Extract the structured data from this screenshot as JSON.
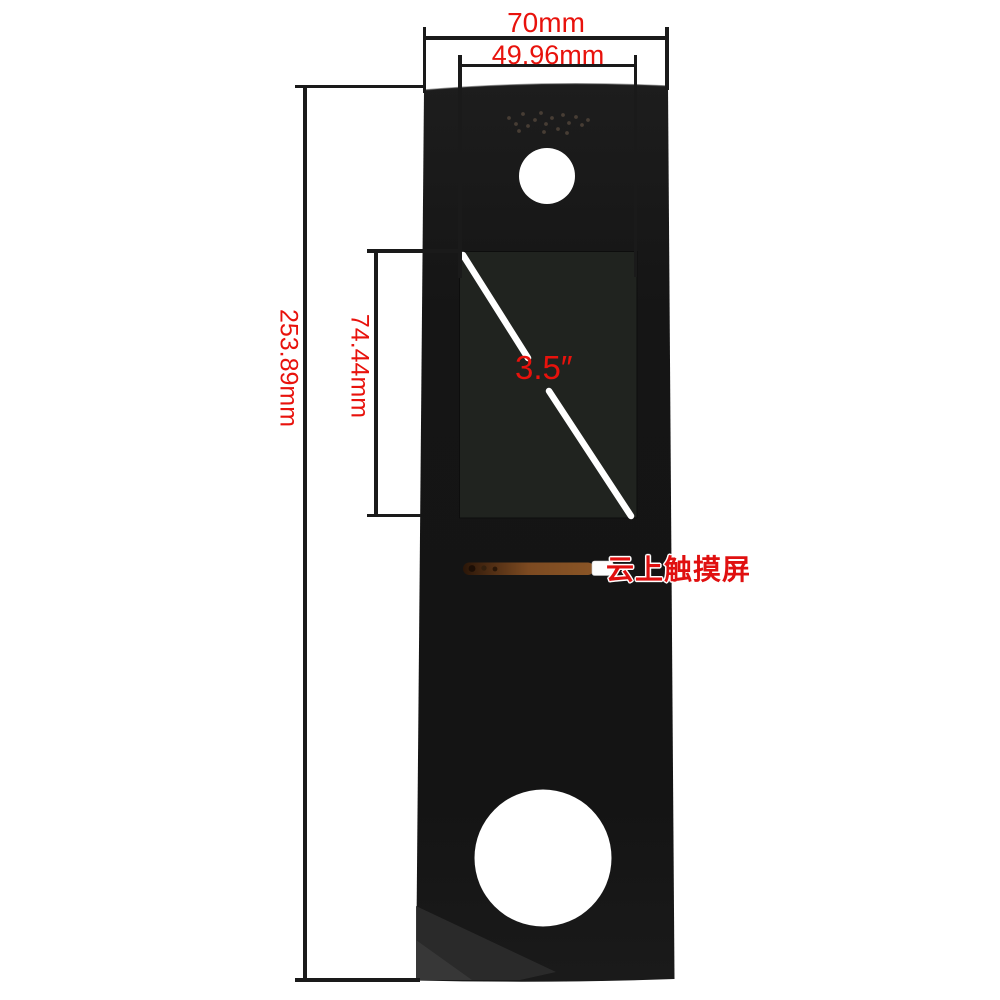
{
  "diagram": {
    "type": "product-dimension-diagram",
    "subject": "3.5 inch touch panel glass front cover"
  },
  "dimensions": {
    "overall_width": "70mm",
    "screen_width": "49.96mm",
    "overall_height": "253.89mm",
    "screen_height": "74.44mm",
    "screen_diagonal": "3.5″"
  },
  "watermark": {
    "text": "云上触摸屏"
  },
  "colors": {
    "background": "#ffffff",
    "dimension_text_red": "#e8120c",
    "dimension_line_black": "#1a1a1a",
    "panel_black": "#161616",
    "screen_black": "#20231f",
    "diagonal_line_white": "#ffffff",
    "flex_cable_copper": "#7c4a21",
    "watermark_red": "#e01010"
  },
  "panel": {
    "speaker_dots": [
      [
        509,
        118
      ],
      [
        516,
        124
      ],
      [
        523,
        114
      ],
      [
        528,
        126
      ],
      [
        535,
        120
      ],
      [
        541,
        113
      ],
      [
        546,
        124
      ],
      [
        552,
        118
      ],
      [
        558,
        129
      ],
      [
        563,
        115
      ],
      [
        569,
        123
      ],
      [
        576,
        117
      ],
      [
        582,
        125
      ],
      [
        588,
        120
      ],
      [
        519,
        131
      ],
      [
        544,
        132
      ],
      [
        567,
        133
      ]
    ]
  }
}
